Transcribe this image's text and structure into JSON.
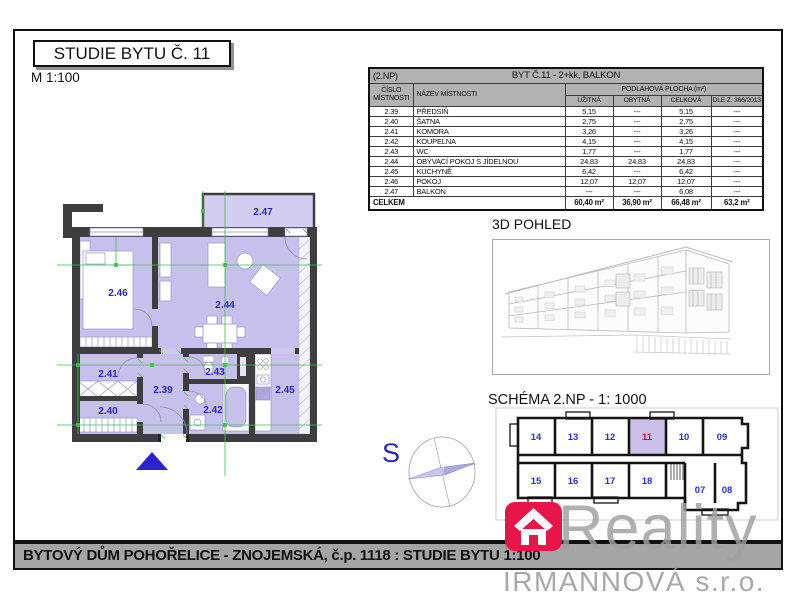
{
  "header": {
    "title": "STUDIE BYTU Č. 11",
    "scale": "M 1:100"
  },
  "sections": {
    "view3d": "3D POHLED",
    "schema": "SCHÉMA 2.NP - 1: 1000"
  },
  "table": {
    "floor": "(2.NP)",
    "title": "BYT Č.11 - 2+kk, BALKON",
    "col_number_line1": "ČÍSLO",
    "col_number_line2": "MÍSTNOSTI",
    "col_name": "NÁZEV MÍSTNOSTI",
    "col_area": "PODLAHOVÁ PLOCHA (m²)",
    "subcols": [
      "UŽITNÁ",
      "OBYTNÁ",
      "CELKOVÁ",
      "DLE Z. 366/2013 sb"
    ],
    "rows": [
      [
        "2.39",
        "PŘEDSÍŇ",
        "5,15",
        "---",
        "5,15",
        "---"
      ],
      [
        "2.40",
        "ŠATNA",
        "2,75",
        "---",
        "2,75",
        "---"
      ],
      [
        "2.41",
        "KOMORA",
        "3,26",
        "---",
        "3,26",
        "---"
      ],
      [
        "2.42",
        "KOUPELNA",
        "4,15",
        "---",
        "4,15",
        "---"
      ],
      [
        "2.43",
        "WC",
        "1,77",
        "---",
        "1,77",
        "---"
      ],
      [
        "2.44",
        "OBÝVACÍ POKOJ S JÍDELNOU",
        "24,83",
        "24,83",
        "24,83",
        "---"
      ],
      [
        "2.45",
        "KUCHYNĚ",
        "6,42",
        "---",
        "6,42",
        "---"
      ],
      [
        "2.46",
        "POKOJ",
        "12,07",
        "12,07",
        "12,07",
        "---"
      ],
      [
        "2.47",
        "BALKON",
        "---",
        "---",
        "6,08",
        "---"
      ]
    ],
    "total": [
      "CELKEM",
      "60,40 m²",
      "36,90 m²",
      "66,48 m²",
      "63,2 m²"
    ]
  },
  "floorplan": {
    "labels": {
      "r239": "2.39",
      "r240": "2.40",
      "r241": "2.41",
      "r242": "2.42",
      "r243": "2.43",
      "r244": "2.44",
      "r245": "2.45",
      "r246": "2.46",
      "r247": "2.47"
    },
    "compass": "S"
  },
  "schema_units": {
    "u14": "14",
    "u13": "13",
    "u12": "12",
    "u11": "11",
    "u10": "10",
    "u09": "09",
    "u15": "15",
    "u16": "16",
    "u17": "17",
    "u18": "18",
    "u07": "07",
    "u08": "08",
    "highlighted": "11"
  },
  "footer": {
    "bar_text": "BYTOVÝ DŮM POHOŘELICE - ZNOJEMSKÁ, č.p. 1118 : STUDIE BYTU 1:100"
  },
  "watermark": {
    "brand": "Reality",
    "company": "IRMANNOVÁ s.r.o."
  },
  "colors": {
    "room_fill": "#c8c0ec",
    "balcony_fill": "#d3cdf2",
    "wall": "#3e3e3e",
    "dimension_green": "#3fbf4a",
    "label_blue": "#2526c9",
    "highlight_fill": "#cbbfe9",
    "highlight_number_red": "#cc1111",
    "bar_gray": "#a5a5a5",
    "header_gray": "#b2b2b2",
    "brand_pink": "#e91548",
    "watermark_gray": "#9f9f9f",
    "north_triangle_blue": "#2a23d6"
  }
}
